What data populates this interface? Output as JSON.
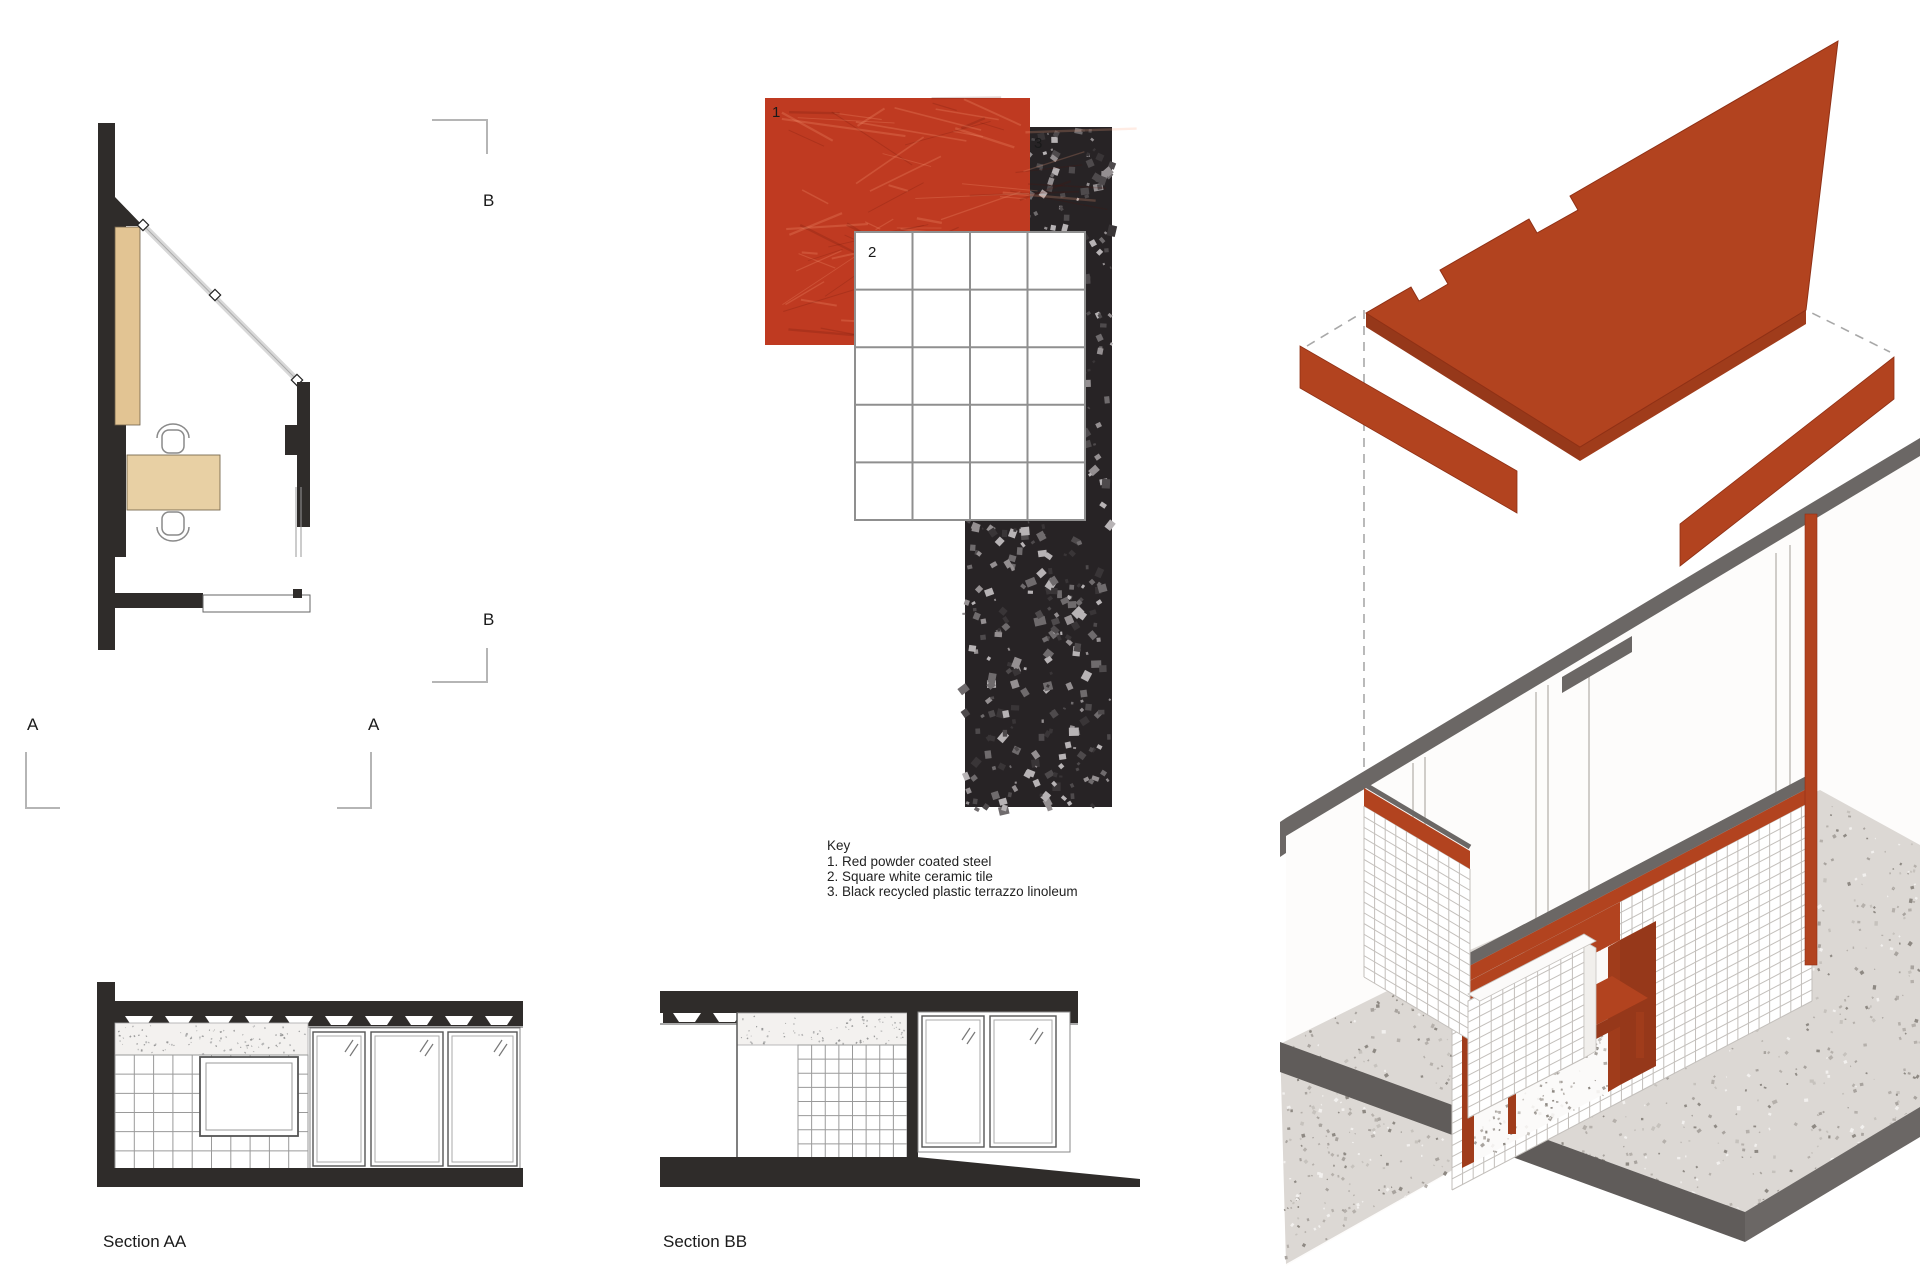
{
  "plan": {
    "marker_b_top": "B",
    "marker_b_bottom": "B",
    "marker_a_left": "A",
    "marker_a_right": "A"
  },
  "swatches": {
    "red_label": "1",
    "tile_label": "2",
    "terrazzo_label": "3"
  },
  "key": {
    "heading": "Key",
    "item1": "1. Red powder coated steel",
    "item2": "2. Square white ceramic tile",
    "item3": "3. Black recycled plastic terrazzo linoleum"
  },
  "sections": {
    "aa_label": "Section AA",
    "bb_label": "Section BB"
  },
  "colors": {
    "steel_red": "#bf3a21",
    "axon_red": "#b2431f",
    "axon_red_dark": "#8f3517",
    "drawing_black": "#2f2c2a",
    "wood": "#e2c493",
    "shell_gray": "#6b6765",
    "terrazzo_black": "#272325",
    "floor_terrazzo": "#dcd8d4"
  }
}
